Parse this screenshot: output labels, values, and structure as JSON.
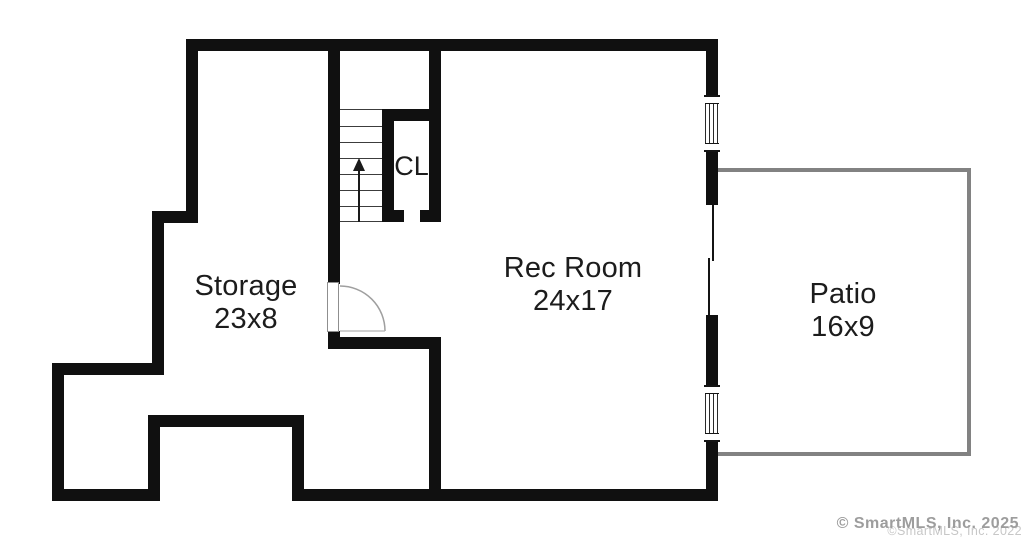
{
  "plan": {
    "type": "floor-plan",
    "rooms": {
      "storage": {
        "name": "Storage",
        "dims": "23x8"
      },
      "rec_room": {
        "name": "Rec Room",
        "dims": "24x17"
      },
      "patio": {
        "name": "Patio",
        "dims": "16x9"
      },
      "closet": {
        "name": "CL"
      }
    },
    "stairs": {
      "direction": "up",
      "tread_count": 8
    }
  },
  "colors": {
    "wall": "#101010",
    "patio_outline": "#828282",
    "label_text": "#1c1c1c",
    "door_swing": "#9f9f9f",
    "watermark_primary": "#9d9d9d",
    "watermark_secondary": "#c7c7c7"
  },
  "watermark": {
    "primary": "© SmartMLS, Inc. 2025",
    "secondary": "©SmartMLS, Inc. 2022"
  }
}
